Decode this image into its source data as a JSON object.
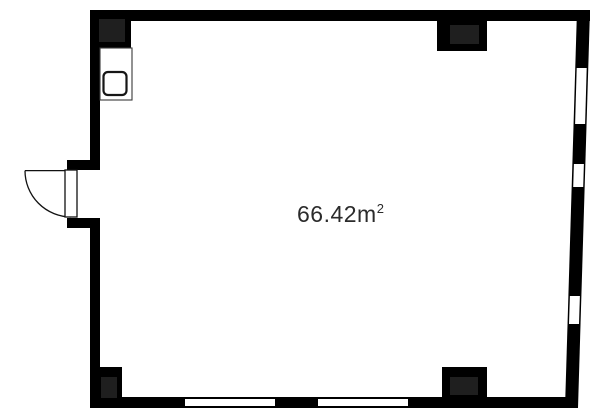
{
  "floor_plan": {
    "area_label": "66.42m²",
    "area_main": "66.42m",
    "area_exponent": "2",
    "colors": {
      "background": "#ffffff",
      "wall": "#000000",
      "pillar_inner": "#1f1f1f",
      "window": "#ffffff",
      "text": "#2b2b2b"
    },
    "features": {
      "door": "left-wall hinged door with quarter swing arc",
      "right_wall_windows": 3,
      "bottom_wall_windows": 2,
      "pillars": 4,
      "fixture": "sink unit at top-left"
    }
  }
}
